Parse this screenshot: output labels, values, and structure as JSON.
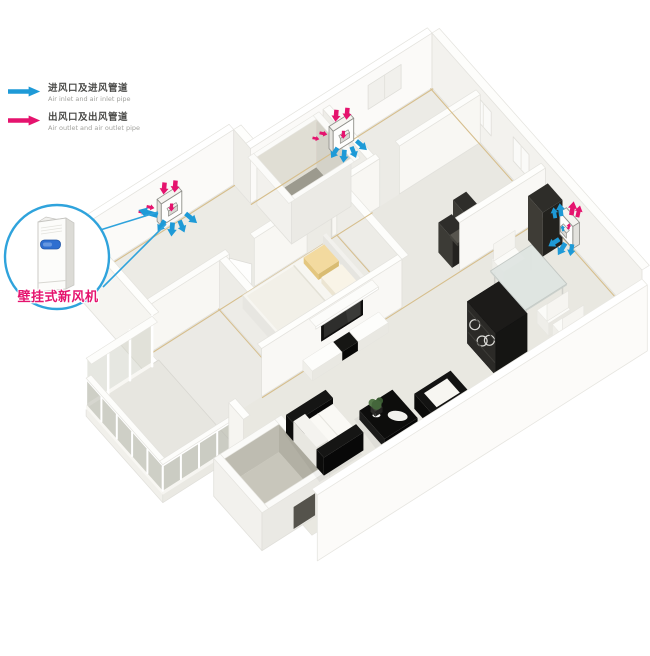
{
  "legend": {
    "inlet": {
      "zh": "进风口及进风管道",
      "en": "Air inlet and air inlet pipe"
    },
    "outlet": {
      "zh": "出风口及出风管道",
      "en": "Air outlet and air outlet pipe"
    }
  },
  "callout": {
    "label": "壁挂式新风机"
  },
  "colors": {
    "inlet_arrow": "#1E9AD7",
    "outlet_arrow": "#E5136E",
    "callout_line": "#2FA3DC",
    "callout_label": "#E5136E"
  },
  "units": [
    {
      "name": "fresh-air-unit-left-bedroom"
    },
    {
      "name": "fresh-air-unit-top-bedroom"
    },
    {
      "name": "fresh-air-unit-dining-room"
    }
  ]
}
